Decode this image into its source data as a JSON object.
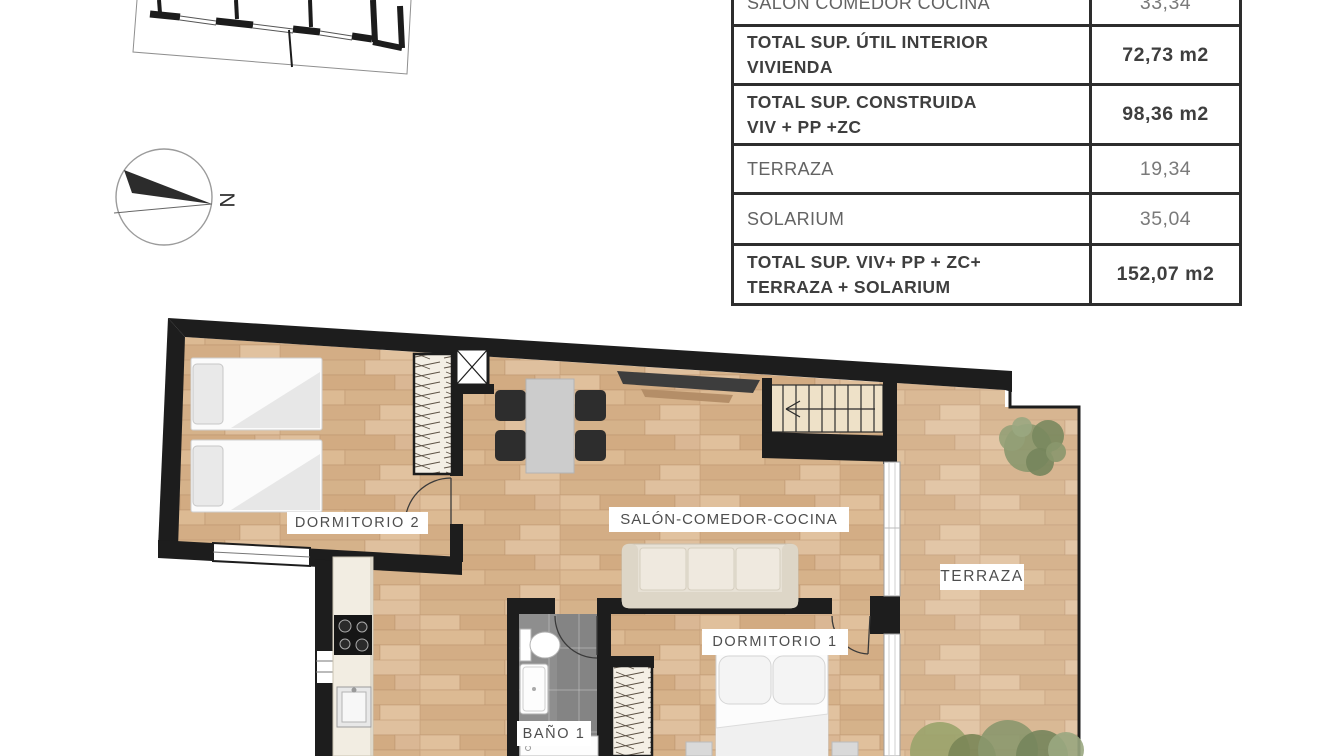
{
  "area_table": {
    "rows": [
      {
        "label_line1": "SALÓN COMEDOR COCINA",
        "label_line2": "",
        "value": "33,34",
        "bold": false
      },
      {
        "label_line1": "TOTAL SUP. ÚTIL INTERIOR",
        "label_line2": "VIVIENDA",
        "value": "72,73 m2",
        "bold": true
      },
      {
        "label_line1": "TOTAL SUP. CONSTRUIDA",
        "label_line2": "VIV + PP +ZC",
        "value": "98,36 m2",
        "bold": true
      },
      {
        "label_line1": "TERRAZA",
        "label_line2": "",
        "value": "19,34",
        "bold": false
      },
      {
        "label_line1": "SOLARIUM",
        "label_line2": "",
        "value": "35,04",
        "bold": false
      },
      {
        "label_line1": "TOTAL SUP. VIV+ PP + ZC+",
        "label_line2": "TERRAZA + SOLARIUM",
        "value": "152,07 m2",
        "bold": true
      }
    ]
  },
  "compass": {
    "north_label": "N"
  },
  "floor_plan": {
    "labels": {
      "dormitorio2": "DORMITORIO 2",
      "salon_comedor_cocina": "SALÓN-COMEDOR-COCINA",
      "terraza": "TERRAZA",
      "dormitorio1": "DORMITORIO 1",
      "bano1": "BAÑO 1"
    },
    "colors": {
      "wall": "#1d1d1d",
      "wood_floor": "#d9b893",
      "terrace_overlay": "#ffffff",
      "bathroom_floor": "#8e8e8e",
      "stairs_floor": "#eee1c8",
      "plant_green": "#87956c"
    }
  }
}
